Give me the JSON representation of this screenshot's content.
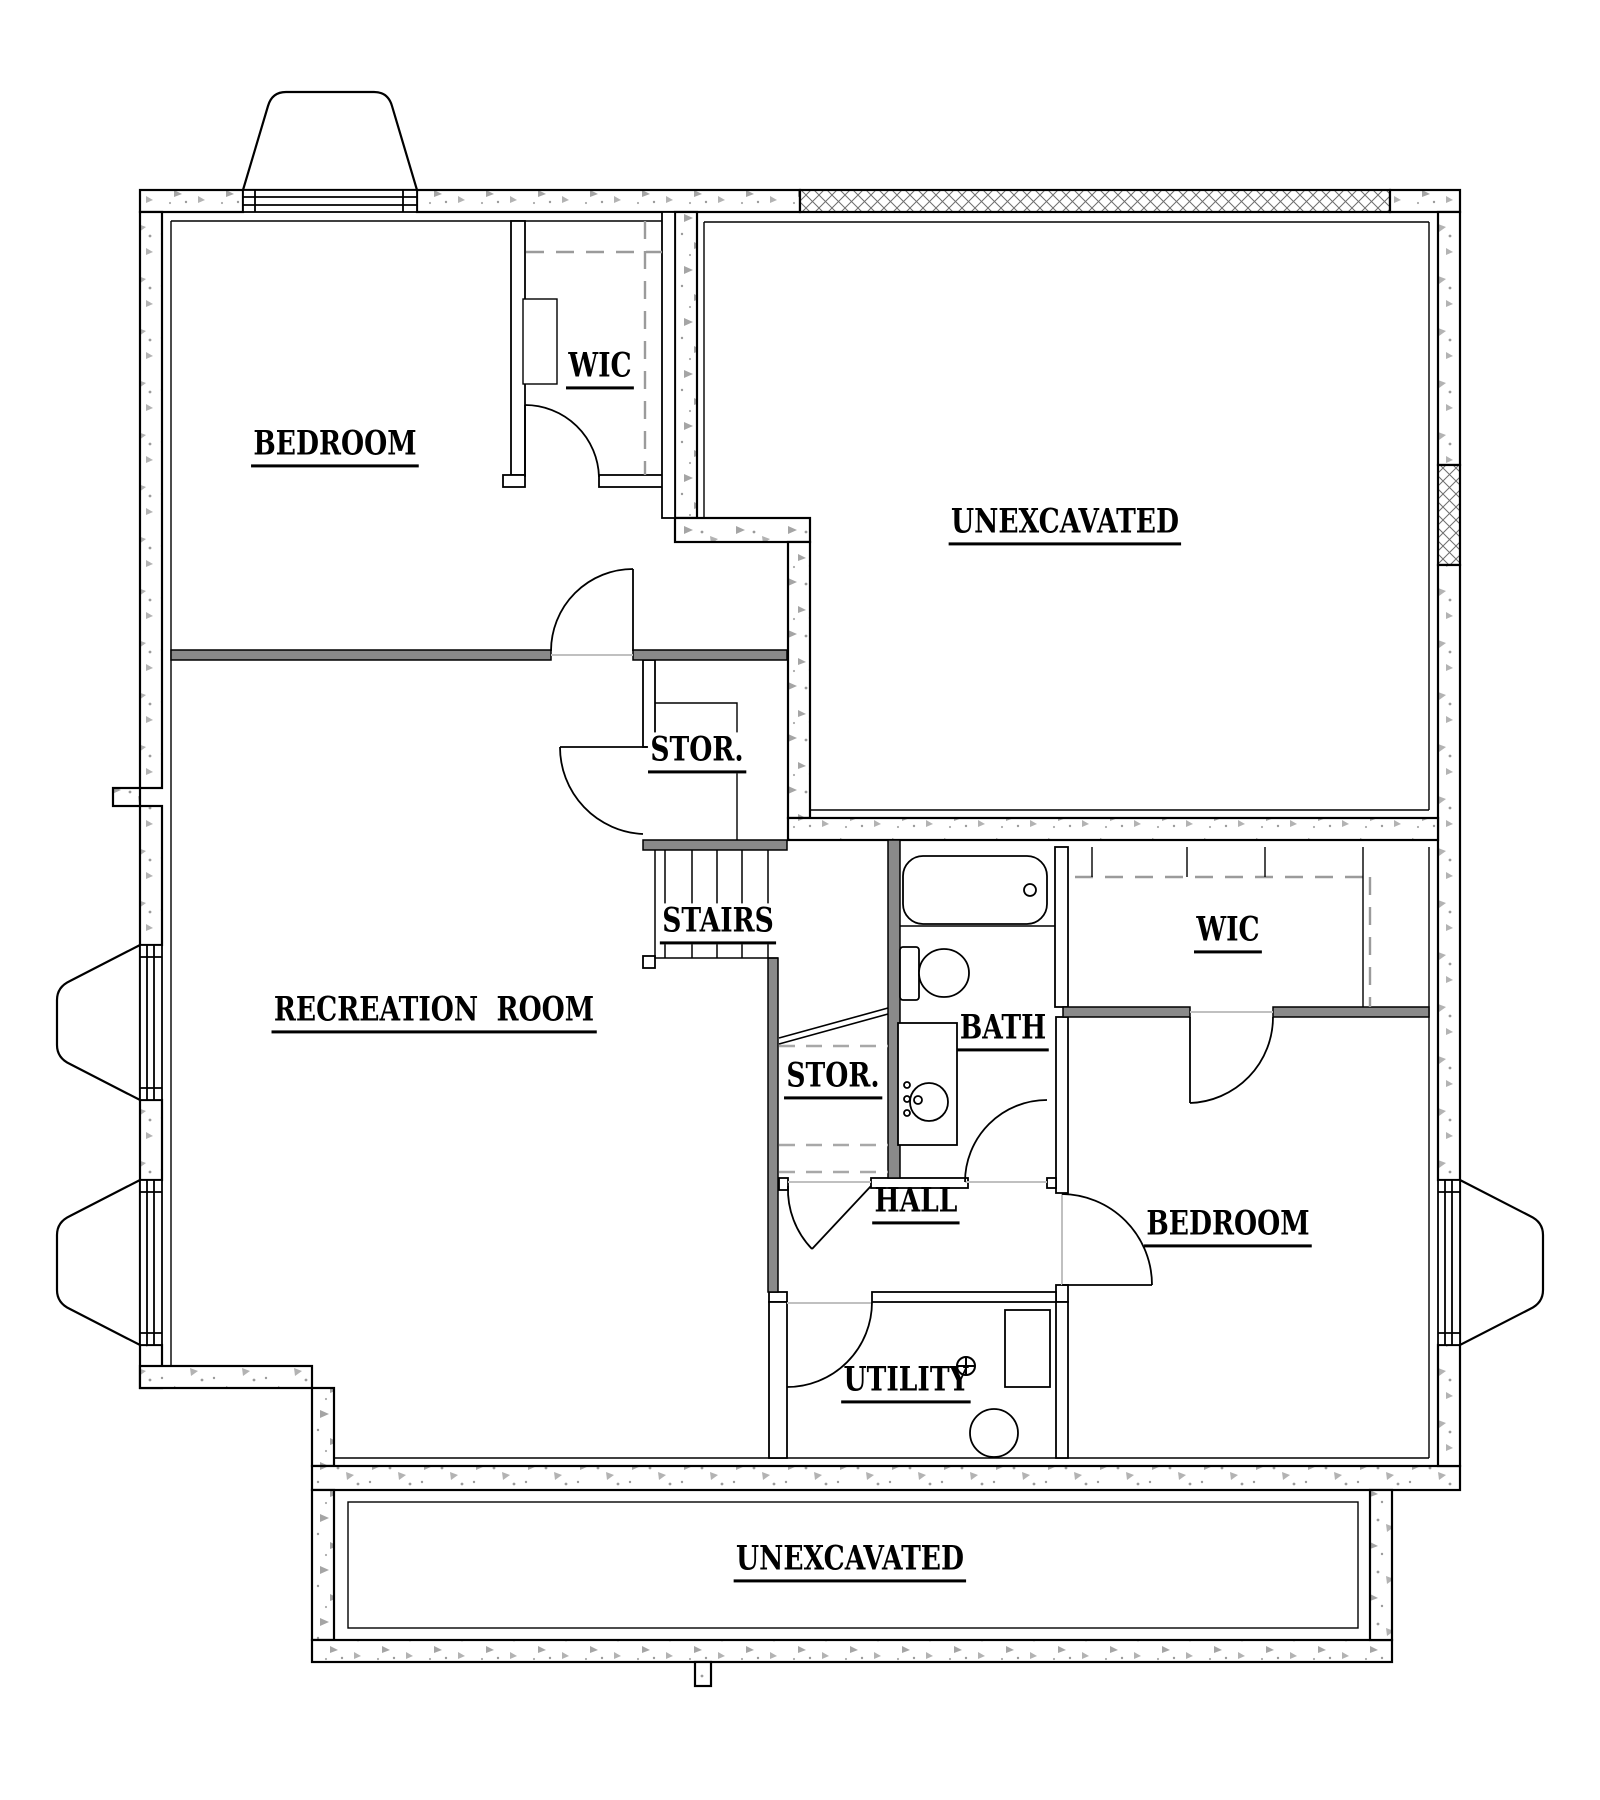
{
  "rooms": {
    "bedroom_top_left": {
      "label": "BEDROOM"
    },
    "wic_top_left": {
      "label": "WIC"
    },
    "unexcavated_top": {
      "label": "UNEXCAVATED"
    },
    "storage_upper": {
      "label": "STOR."
    },
    "stairs": {
      "label": "STAIRS"
    },
    "recreation": {
      "label": "RECREATION  ROOM"
    },
    "storage_under_stairs": {
      "label": "STOR."
    },
    "bath": {
      "label": "BATH"
    },
    "wic_right": {
      "label": "WIC"
    },
    "hall": {
      "label": "HALL"
    },
    "bedroom_right": {
      "label": "BEDROOM"
    },
    "utility": {
      "label": "UTILITY"
    },
    "unexcavated_bottom": {
      "label": "UNEXCAVATED"
    }
  },
  "colors": {
    "line": "#000000",
    "partition_wall": "#8a8a8a",
    "concrete_speckle": "#9b9b9b",
    "open_doorway_line": "#c0c0c0",
    "background": "#ffffff"
  }
}
